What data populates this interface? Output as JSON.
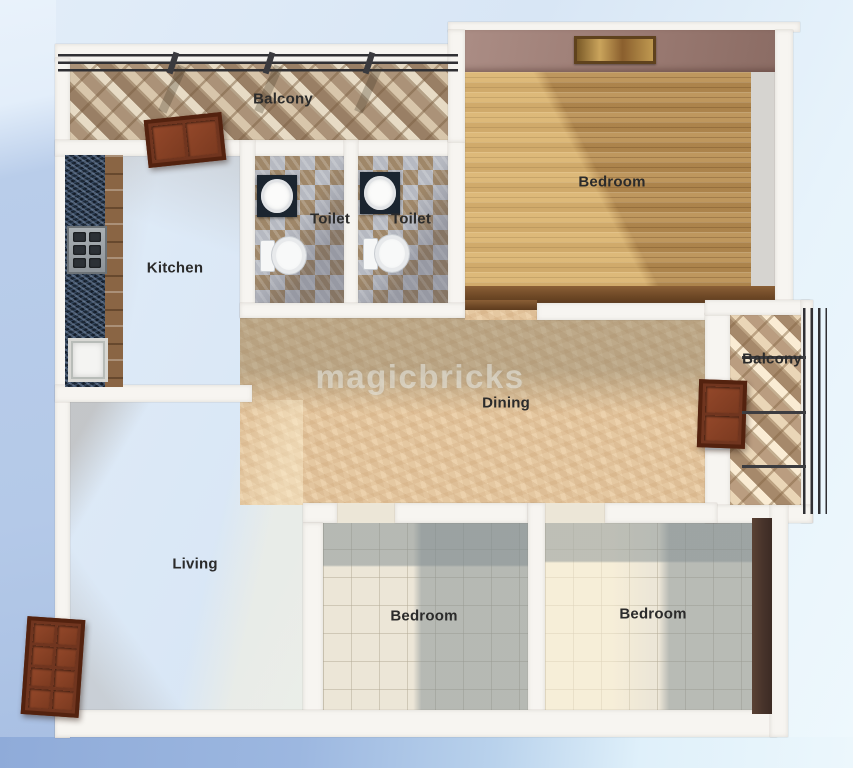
{
  "floor_plan": {
    "type": "3d-rendered apartment floor plan, top-down view",
    "watermark": "magicbricks",
    "rooms": [
      {
        "id": "balcony-top",
        "label": "Balcony"
      },
      {
        "id": "kitchen",
        "label": "Kitchen"
      },
      {
        "id": "toilet-left",
        "label": "Toilet"
      },
      {
        "id": "toilet-right",
        "label": "Toilet"
      },
      {
        "id": "bedroom-master",
        "label": "Bedroom"
      },
      {
        "id": "balcony-right",
        "label": "Balcony"
      },
      {
        "id": "dining",
        "label": "Dining"
      },
      {
        "id": "living",
        "label": "Living"
      },
      {
        "id": "bedroom-bottom-left",
        "label": "Bedroom"
      },
      {
        "id": "bedroom-bottom-right",
        "label": "Bedroom"
      }
    ],
    "fixtures": [
      "kitchen-granite-counter",
      "gas-stove",
      "kitchen-sink",
      "washbasin-toilet-left",
      "wc-toilet-left",
      "washbasin-toilet-right",
      "wc-toilet-right",
      "picture-frame-bedroom",
      "entrance-door",
      "balcony-door-top",
      "balcony-door-right",
      "balcony-railing-top",
      "balcony-railing-right"
    ],
    "colors": {
      "wall_white": "#f7f5f1",
      "wall_mauve": "#9a7a72",
      "wall_dark_brown": "#46322a",
      "floor_beige": "#e5c8a1",
      "floor_wood": "#c59a5e",
      "floor_white_tile": "#ece6d7",
      "tile_checker_gray": "#b6b9c1",
      "tile_checker_brown": "#9f8769",
      "granite_counter": "#1c2836",
      "door_brown": "#70351f",
      "background_blue": "#d8e6f5",
      "background_bottom_blue": "#8fabd9",
      "label_text": "#2b2b2b"
    }
  }
}
